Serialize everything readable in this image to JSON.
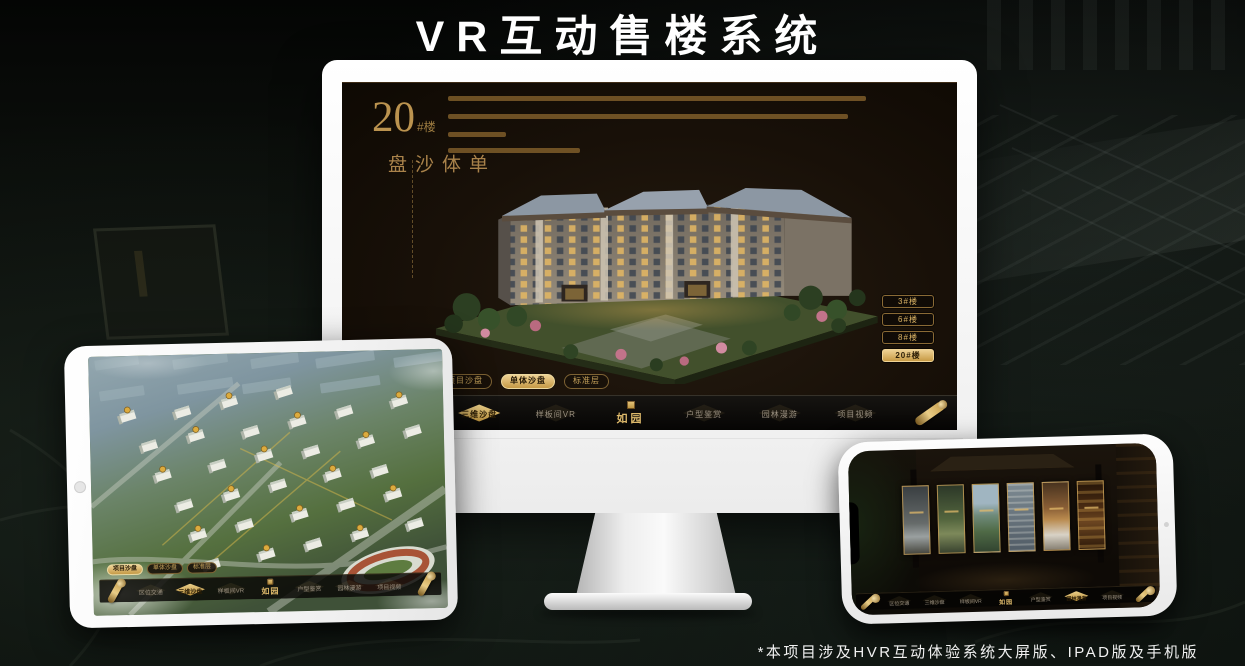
{
  "page": {
    "title": "VR互动售楼系统",
    "footnote": "*本项目涉及HVR互动体验系统大屏版、IPAD版及手机版"
  },
  "brand": {
    "logo": "如园",
    "accent_gold": "#c9a35a",
    "accent_gold_bright": "#ecd095"
  },
  "monitor_app": {
    "hero": {
      "number": "20",
      "suffix": "#楼",
      "subtitle": "单体沙盘"
    },
    "view_tabs": [
      {
        "label": "项目沙盘",
        "active": false
      },
      {
        "label": "单体沙盘",
        "active": true
      },
      {
        "label": "标准层",
        "active": false
      }
    ],
    "building_buttons": [
      {
        "label": "3#楼",
        "active": false
      },
      {
        "label": "6#楼",
        "active": false
      },
      {
        "label": "8#楼",
        "active": false
      },
      {
        "label": "20#楼",
        "active": true
      }
    ],
    "nav_left": [
      {
        "label": "区位交通",
        "active": false
      },
      {
        "label": "三维沙盘",
        "active": true
      },
      {
        "label": "样板间VR",
        "active": false
      }
    ],
    "nav_right": [
      {
        "label": "户型鉴赏",
        "active": false
      },
      {
        "label": "园林漫游",
        "active": false
      },
      {
        "label": "项目视频",
        "active": false
      }
    ]
  },
  "tablet_app": {
    "view_tabs": [
      {
        "label": "项目沙盘",
        "active": true
      },
      {
        "label": "单体沙盘",
        "active": false
      },
      {
        "label": "标准层",
        "active": false
      }
    ],
    "nav_left": [
      {
        "label": "区位交通",
        "active": false
      },
      {
        "label": "三维沙盘",
        "active": true
      },
      {
        "label": "样板间VR",
        "active": false
      }
    ],
    "nav_right": [
      {
        "label": "户型鉴赏",
        "active": false
      },
      {
        "label": "园林漫游",
        "active": false
      },
      {
        "label": "项目视频",
        "active": false
      }
    ]
  },
  "phone_app": {
    "nav_left": [
      {
        "label": "区位交通",
        "active": false
      },
      {
        "label": "三维沙盘",
        "active": false
      },
      {
        "label": "样板间VR",
        "active": false
      }
    ],
    "nav_right": [
      {
        "label": "户型鉴赏",
        "active": false
      },
      {
        "label": "园林漫游",
        "active": true
      },
      {
        "label": "项目视频",
        "active": false
      }
    ]
  }
}
